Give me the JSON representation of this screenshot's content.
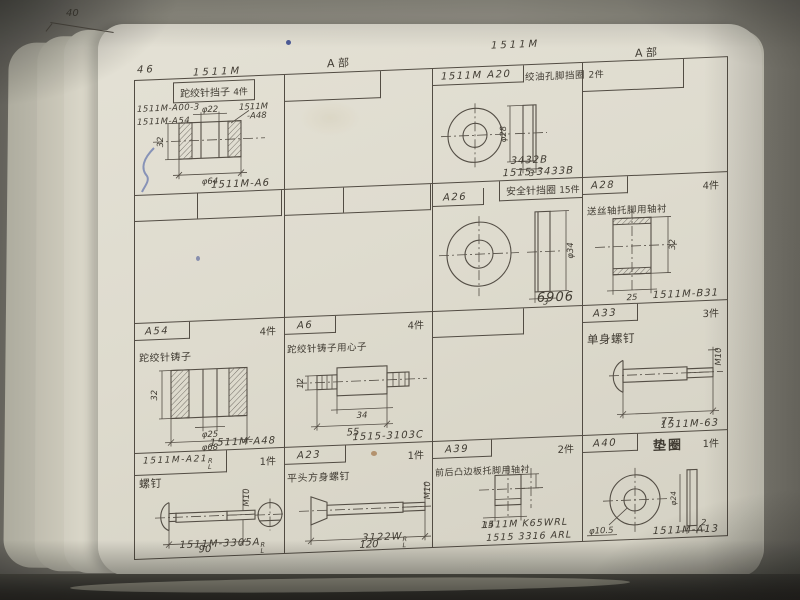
{
  "photo": {
    "margin_note": "40",
    "page_number": "46"
  },
  "headers": {
    "h1": "1511M",
    "h2": "A 部",
    "h3": "1511M",
    "h4": "A 部"
  },
  "colors": {
    "paper": "#dcdbd1",
    "ink": "#4f4941",
    "blue_ink": "#2c3f92"
  },
  "cells": {
    "r1c1": {
      "title": "跎绞针挡子",
      "qty": "4件",
      "ref1": "1511M-A00-3",
      "ref2": "1511M-A54",
      "callout1": "1511M",
      "callout2": "-A48",
      "dim_top": "φ22",
      "dim_bottom": "φ64",
      "dim_left": "32",
      "footer": "1511M-A6"
    },
    "r1c3": {
      "label": "1511M A20",
      "title": "绞油孔脚挡圈",
      "qty": "2件",
      "dim_side": "φ28",
      "dim_thickness": "3",
      "footer1": "3432B",
      "footer2": "1515-3433B"
    },
    "r2c3": {
      "label": "A26",
      "title": "安全针挡圈",
      "qty": "15件",
      "dim_side": "φ34",
      "dim_thickness": "3",
      "footer": "6906"
    },
    "r2c4": {
      "label": "A28",
      "title": "送丝轴托脚用轴衬",
      "qty": "4件",
      "dim_side": "32",
      "dim_bottom": "25",
      "footer": "1511M-B31"
    },
    "r3c1": {
      "label": "A54",
      "title": "跎绞针铸子",
      "qty": "4件",
      "dim_inner": "φ25",
      "dim_bottom": "φ68",
      "dim_left": "32",
      "footer": "1511M-A48"
    },
    "r3c2": {
      "label": "A6",
      "title": "跎绞针铸子用心子",
      "qty": "4件",
      "dim_left": "12",
      "dim_inner": "34",
      "dim_outer": "55",
      "footer": "1515-3103C"
    },
    "r3c4": {
      "label": "A33",
      "title": "单身螺钉",
      "qty": "3件",
      "dim_thread": "M10",
      "dim_length": "77",
      "footer": "1511M-63"
    },
    "r4c1": {
      "label": "1511M-A21",
      "label_sup": "R",
      "label_sub": "L",
      "title": "螺钉",
      "qty": "1件",
      "dim_thread": "M10",
      "dim_length": "90",
      "footer": "1511M-3305A",
      "footer_sup": "R",
      "footer_sub": "L"
    },
    "r4c2": {
      "label": "A23",
      "title": "平头方身螺钉",
      "qty": "1件",
      "dim_thread": "M10",
      "dim_length": "120",
      "footer": "3122W",
      "footer_sup": "R",
      "footer_sub": "L"
    },
    "r4c3": {
      "label": "A39",
      "title": "前后凸边板托脚用轴衬",
      "qty": "2件",
      "dim_width": "14",
      "footer1": "1511M K65WRL",
      "footer2": "1515 3316 ARL"
    },
    "r4c4": {
      "label": "A40",
      "title": "垫圈",
      "qty": "1件",
      "dim_hole": "φ10.5",
      "dim_side": "φ24",
      "dim_thickness": "2",
      "footer": "1511M-A13"
    }
  }
}
